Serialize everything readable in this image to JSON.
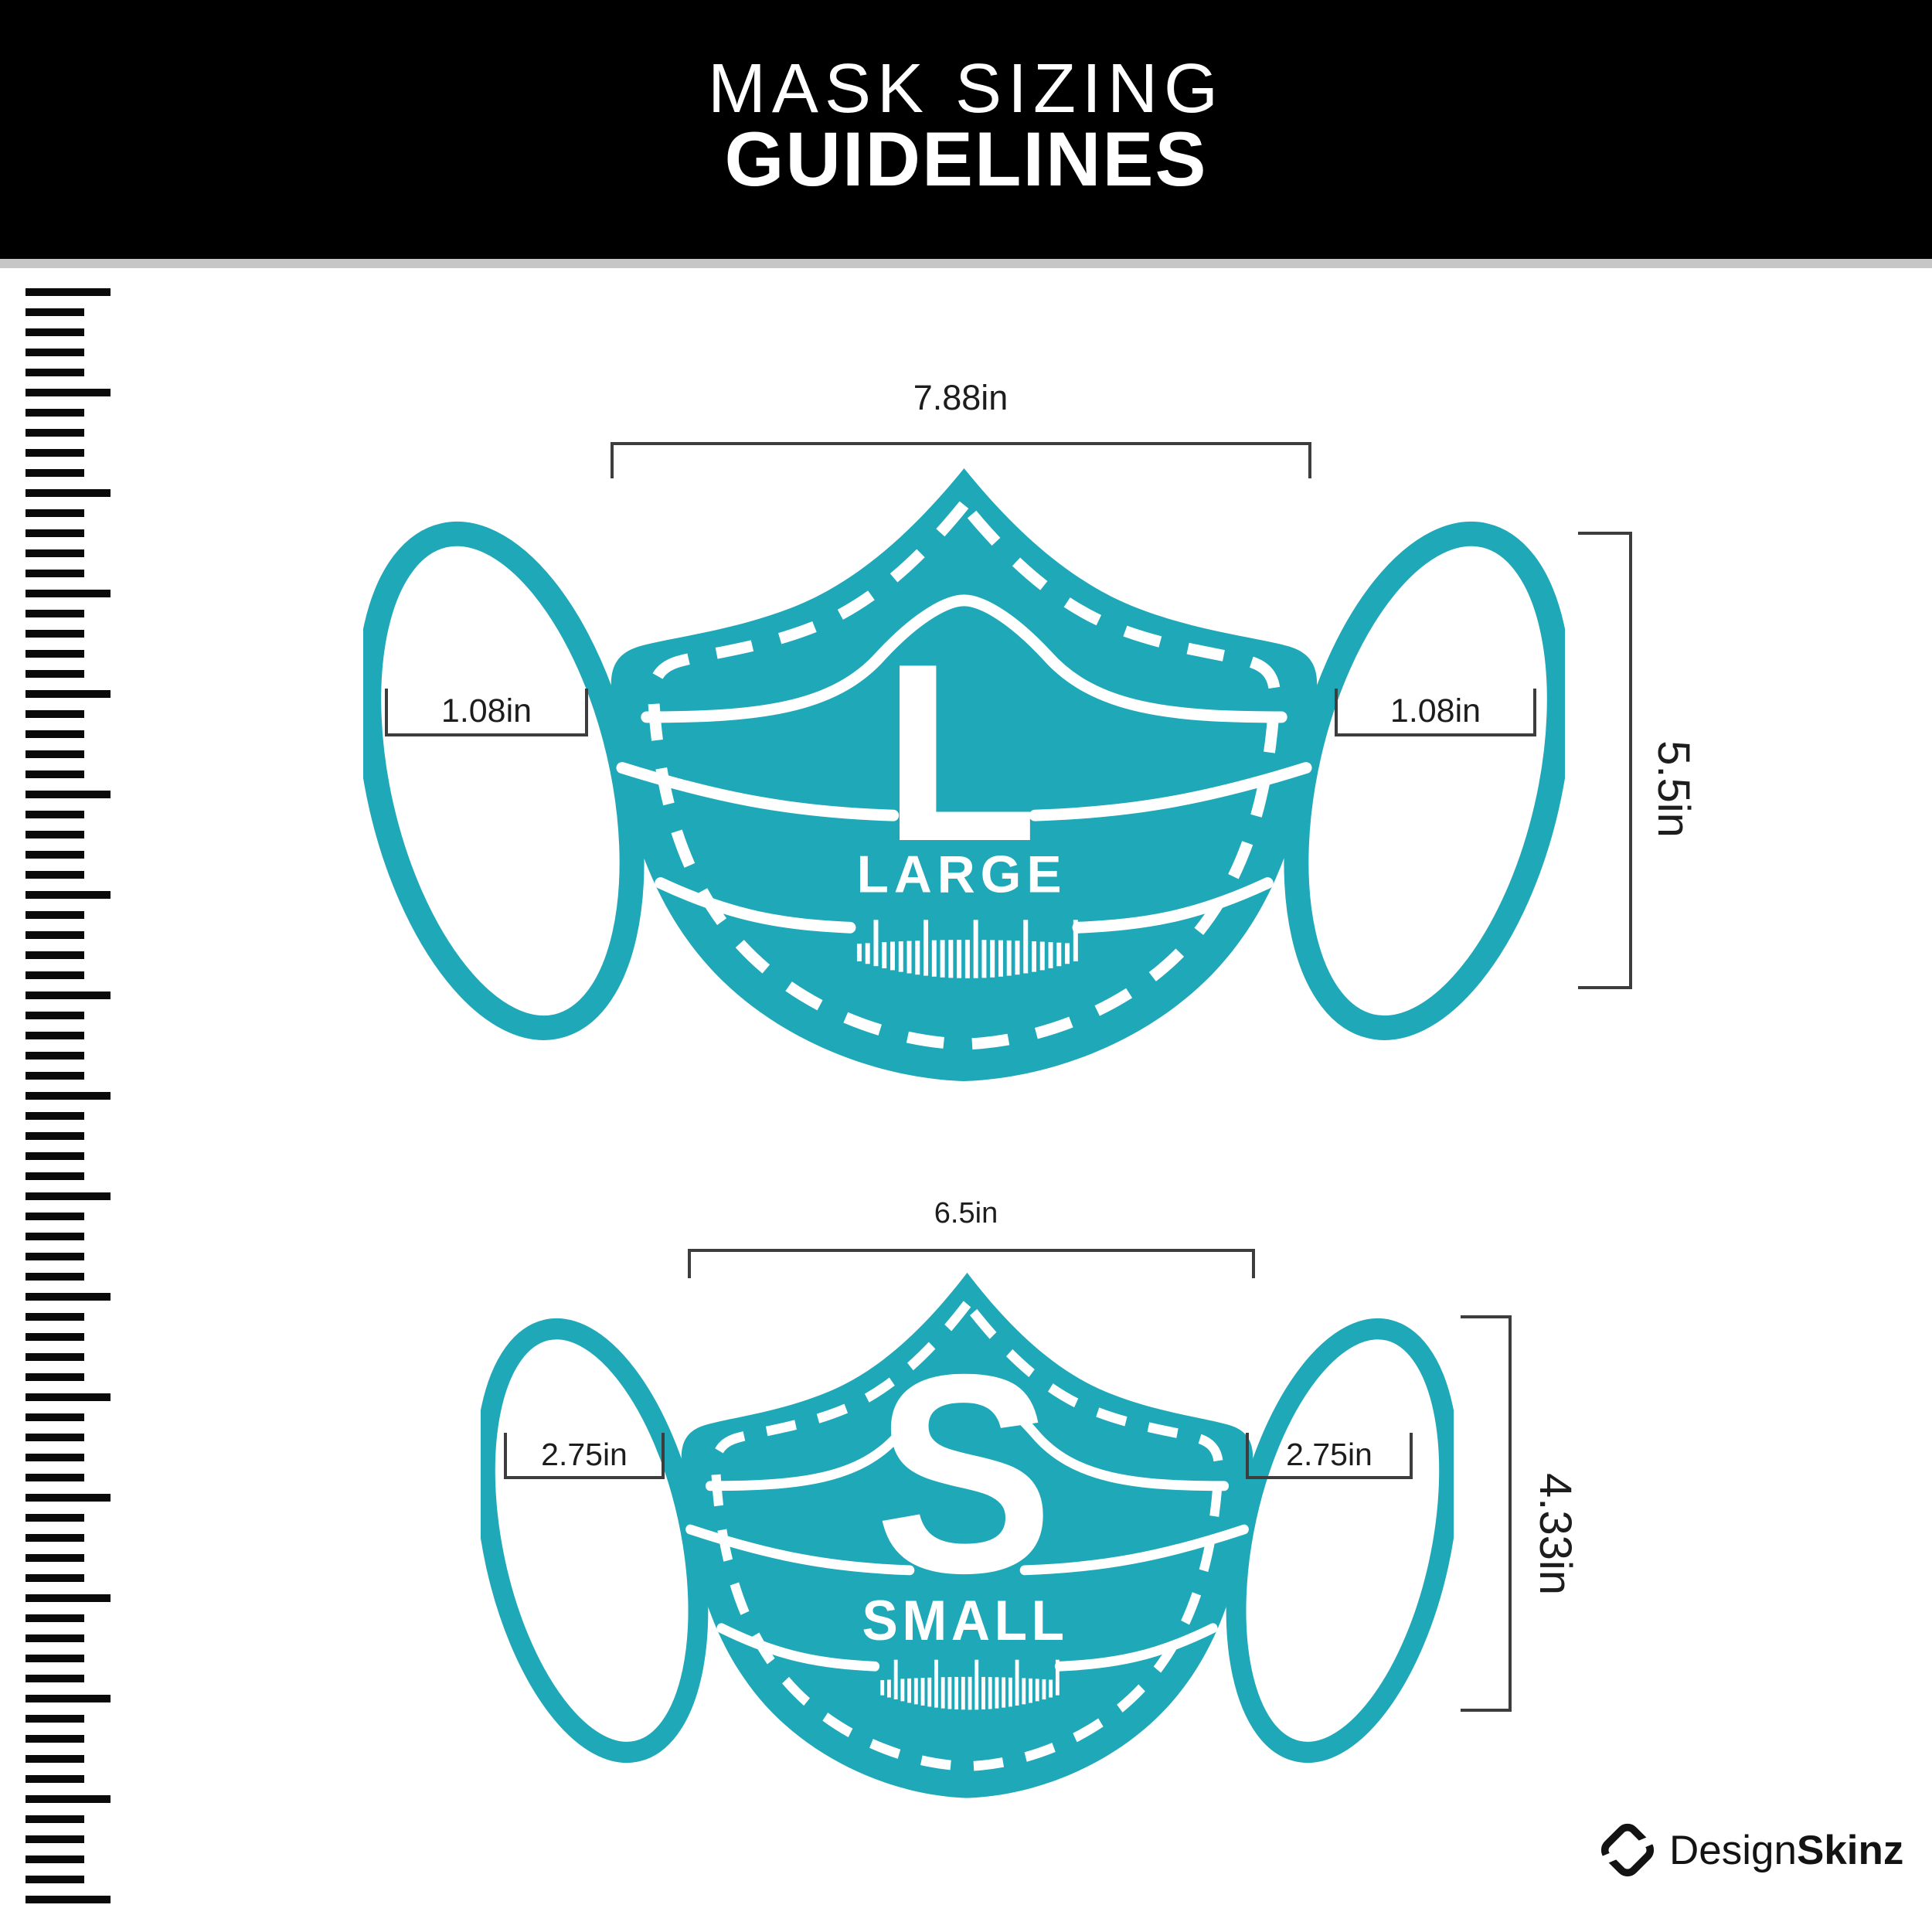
{
  "header": {
    "title_line1": "MASK SIZING",
    "title_line2": "GUIDELINES"
  },
  "masks": {
    "large": {
      "letter": "L",
      "name": "LARGE",
      "width": "7.88in",
      "ear_left": "1.08in",
      "ear_right": "1.08in",
      "height": "5.5in"
    },
    "small": {
      "letter": "S",
      "name": "SMALL",
      "width": "6.5in",
      "ear_left": "2.75in",
      "ear_right": "2.75in",
      "height": "4.33in"
    }
  },
  "brand": {
    "name_regular": "Design",
    "name_bold": "Skinz",
    "logo_icon": "designskinz-s-icon"
  },
  "decorations": {
    "left_ruler_icon": "vertical-ruler",
    "mask_comb_icon": "mini-ruler-glyph"
  },
  "colors": {
    "mask_teal": "#1FA8B8",
    "dimension_line": "#3D3D3D",
    "header_bg": "#000000",
    "divider_gray": "#C6C6C6",
    "ruler_black": "#0A0A0A",
    "logo_black": "#131313",
    "text_white": "#FFFFFF"
  }
}
